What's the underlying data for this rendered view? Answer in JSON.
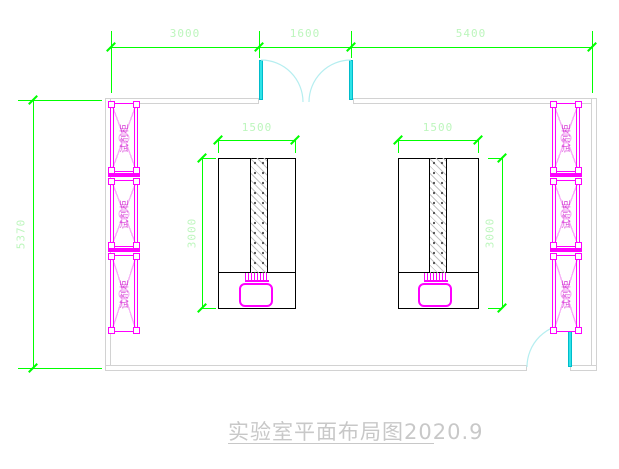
{
  "drawing": {
    "title": "实验室平面布局图2020.9",
    "dimensions": {
      "top_left": "3000",
      "top_middle": "1600",
      "top_right": "5400",
      "room_height": "5370",
      "bench_width": "1500",
      "bench_depth": "3000"
    },
    "cabinets": {
      "label": "试剂柜"
    },
    "colors": {
      "dimension_line": "#00ff00",
      "dimension_text": "#bdf6bd",
      "wall": "#d2d2d2",
      "cabinet": "#ff00ff",
      "cabinet_light": "#f6aef6",
      "door_leaf": "#2ee3e8",
      "door_arc": "#b5eef0",
      "bench": "#000000",
      "title_text": "#c8c8c8"
    }
  }
}
